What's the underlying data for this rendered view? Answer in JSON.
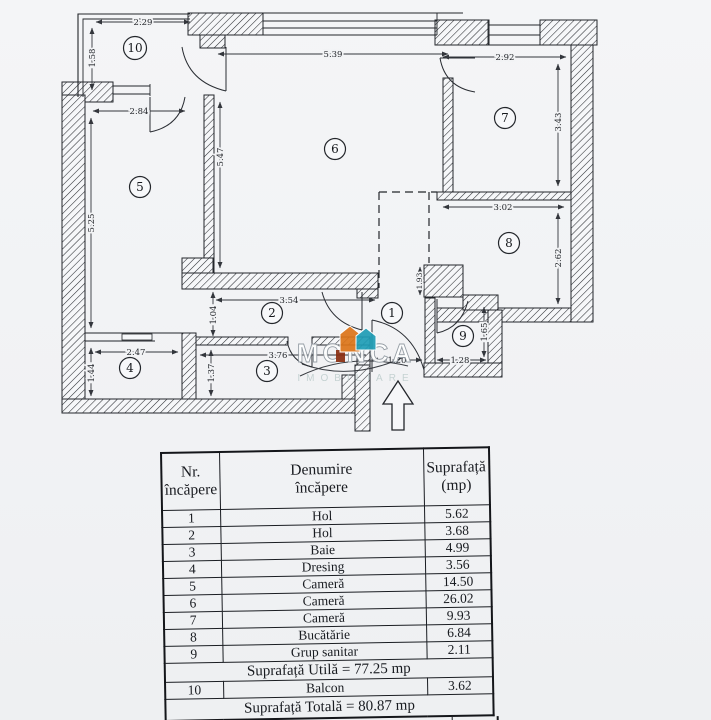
{
  "plan": {
    "rooms": {
      "r1": "1",
      "r2": "2",
      "r3": "3",
      "r4": "4",
      "r5": "5",
      "r6": "6",
      "r7": "7",
      "r8": "8",
      "r9": "9",
      "r10": "10"
    },
    "dims": {
      "d229": "2.29",
      "d158": "1.58",
      "d284": "2.84",
      "d525": "5.25",
      "d539": "5.39",
      "d547": "5.47",
      "d292": "2.92",
      "d343": "3.43",
      "d302": "3.02",
      "d262": "2.62",
      "d193": "1.93",
      "d354": "3.54",
      "d104": "1.04",
      "d247": "2.47",
      "d144": "1.44",
      "d376": "3.76",
      "d137": "1.37",
      "d128": "1.28",
      "d165": "1.65",
      "d120": "1.20"
    },
    "watermark": {
      "name": "MONCA",
      "tagline": "IMOBILIARE",
      "colors": {
        "orange": "#dd7519",
        "teal": "#1f9db6",
        "maroon": "#8a2d10"
      }
    }
  },
  "table": {
    "headers": {
      "nr1": "Nr.",
      "nr2": "încăpere",
      "den1": "Denumire",
      "den2": "încăpere",
      "sup1": "Suprafață",
      "sup2": "(mp)"
    },
    "rows": [
      {
        "nr": "1",
        "name": "Hol",
        "mp": "5.62"
      },
      {
        "nr": "2",
        "name": "Hol",
        "mp": "3.68"
      },
      {
        "nr": "3",
        "name": "Baie",
        "mp": "4.99"
      },
      {
        "nr": "4",
        "name": "Dresing",
        "mp": "3.56"
      },
      {
        "nr": "5",
        "name": "Cameră",
        "mp": "14.50"
      },
      {
        "nr": "6",
        "name": "Cameră",
        "mp": "26.02"
      },
      {
        "nr": "7",
        "name": "Cameră",
        "mp": "9.93"
      },
      {
        "nr": "8",
        "name": "Bucătărie",
        "mp": "6.84"
      },
      {
        "nr": "9",
        "name": "Grup sanitar",
        "mp": "2.11"
      }
    ],
    "utila": "Suprafață Utilă = 77.25 mp",
    "balcon": {
      "nr": "10",
      "name": "Balcon",
      "mp": "3.62"
    },
    "totala": "Suprafață Totală = 80.87 mp",
    "partial_text": "F"
  }
}
